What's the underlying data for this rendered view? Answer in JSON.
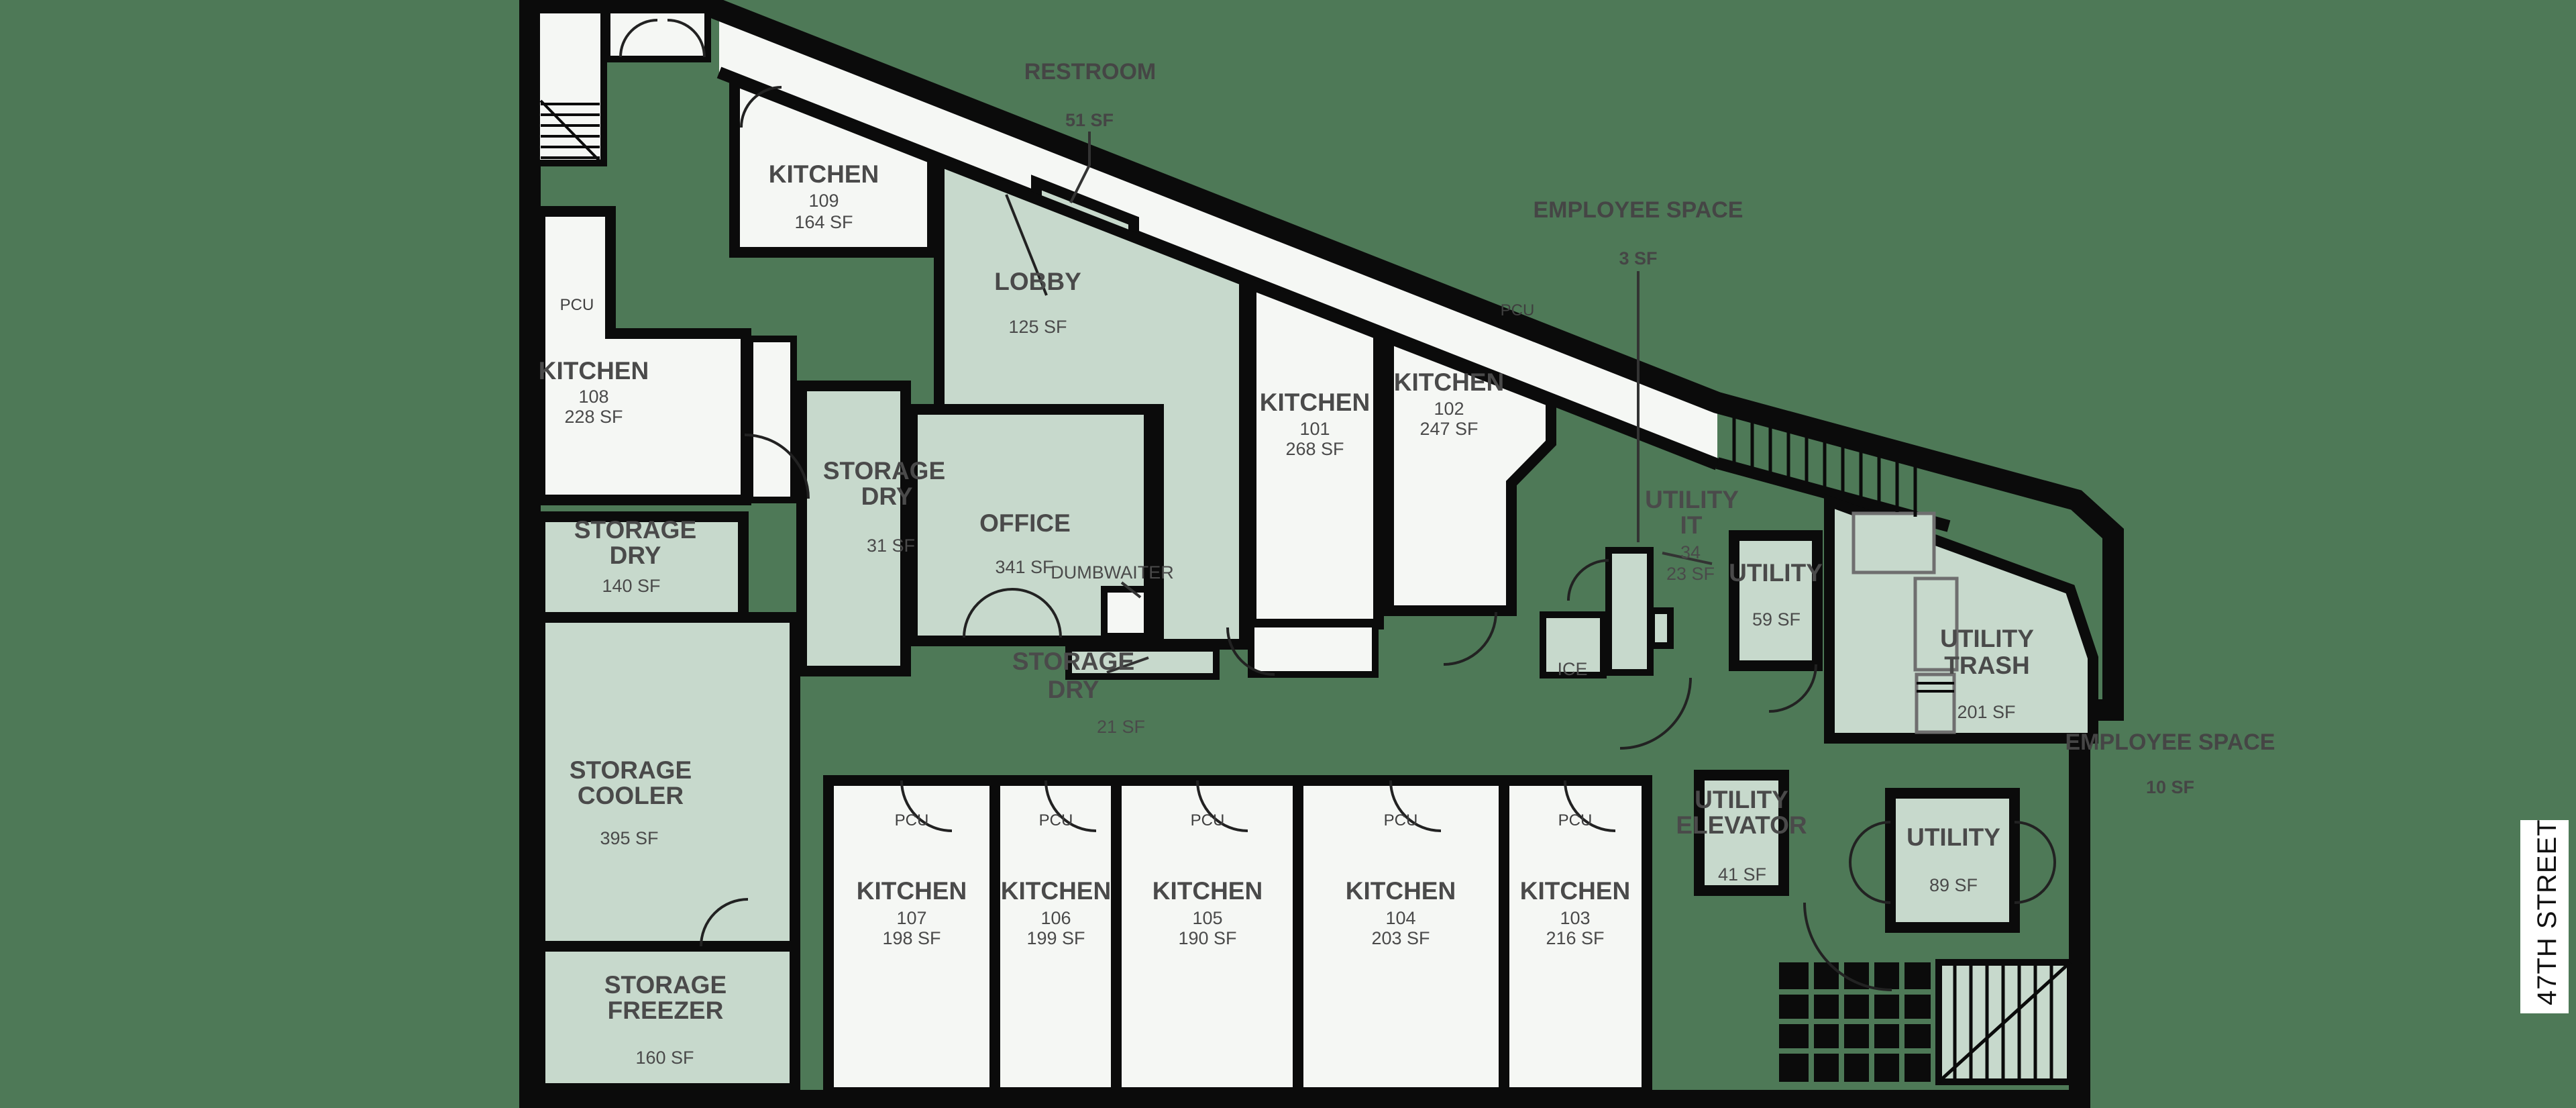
{
  "street": {
    "label": "47TH STREET"
  },
  "labels": {
    "pcu": "PCU"
  },
  "colors": {
    "background": "#4e7957",
    "kitchen_room": "#f5f7f4",
    "support_room": "#c7d9cc",
    "wall": "#0b0b0b",
    "label_text": "#4a4a4a"
  },
  "rooms": {
    "kitchen_101": {
      "name": "KITCHEN",
      "number": "101",
      "area": "268 SF"
    },
    "kitchen_102": {
      "name": "KITCHEN",
      "number": "102",
      "area": "247 SF"
    },
    "kitchen_103": {
      "name": "KITCHEN",
      "number": "103",
      "area": "216 SF"
    },
    "kitchen_104": {
      "name": "KITCHEN",
      "number": "104",
      "area": "203 SF"
    },
    "kitchen_105": {
      "name": "KITCHEN",
      "number": "105",
      "area": "190 SF"
    },
    "kitchen_106": {
      "name": "KITCHEN",
      "number": "106",
      "area": "199 SF"
    },
    "kitchen_107": {
      "name": "KITCHEN",
      "number": "107",
      "area": "198 SF"
    },
    "kitchen_108": {
      "name": "KITCHEN",
      "number": "108",
      "area": "228 SF"
    },
    "kitchen_109": {
      "name": "KITCHEN",
      "number": "109",
      "area": "164 SF"
    },
    "office": {
      "name": "OFFICE",
      "area": "341 SF"
    },
    "lobby": {
      "name": "LOBBY",
      "area": "125 SF"
    },
    "storage_dry_main": {
      "line1": "STORAGE",
      "line2": "DRY",
      "area": "140 SF"
    },
    "storage_dry_side": {
      "line1": "STORAGE",
      "line2": "DRY",
      "area": "31 SF"
    },
    "storage_dry_center": {
      "line1": "STORAGE",
      "line2": "DRY",
      "area": "21 SF"
    },
    "storage_cooler": {
      "line1": "STORAGE",
      "line2": "COOLER",
      "area": "395 SF"
    },
    "storage_freezer": {
      "line1": "STORAGE",
      "line2": "FREEZER",
      "area": "160 SF"
    },
    "utility_it": {
      "line1": "UTILITY",
      "line2": "IT",
      "line3": "34",
      "area": "23 SF"
    },
    "utility_small": {
      "name": "UTILITY",
      "area": "59 SF"
    },
    "utility_trash": {
      "line1": "UTILITY",
      "line2": "TRASH",
      "area": "201 SF"
    },
    "utility_rear": {
      "name": "UTILITY",
      "area": "89 SF"
    },
    "utility_elevator": {
      "line1": "UTILITY",
      "line2": "ELEVATOR",
      "area": "41 SF"
    },
    "dumbwaiter": {
      "name": "DUMBWAITER"
    },
    "ice": {
      "name": "ICE"
    }
  },
  "annotations": {
    "restroom": {
      "name": "RESTROOM",
      "area": "51 SF"
    },
    "employee_space_top": {
      "name": "EMPLOYEE SPACE",
      "area": "3 SF"
    },
    "employee_space_right": {
      "name": "EMPLOYEE SPACE",
      "area": "10 SF"
    }
  }
}
